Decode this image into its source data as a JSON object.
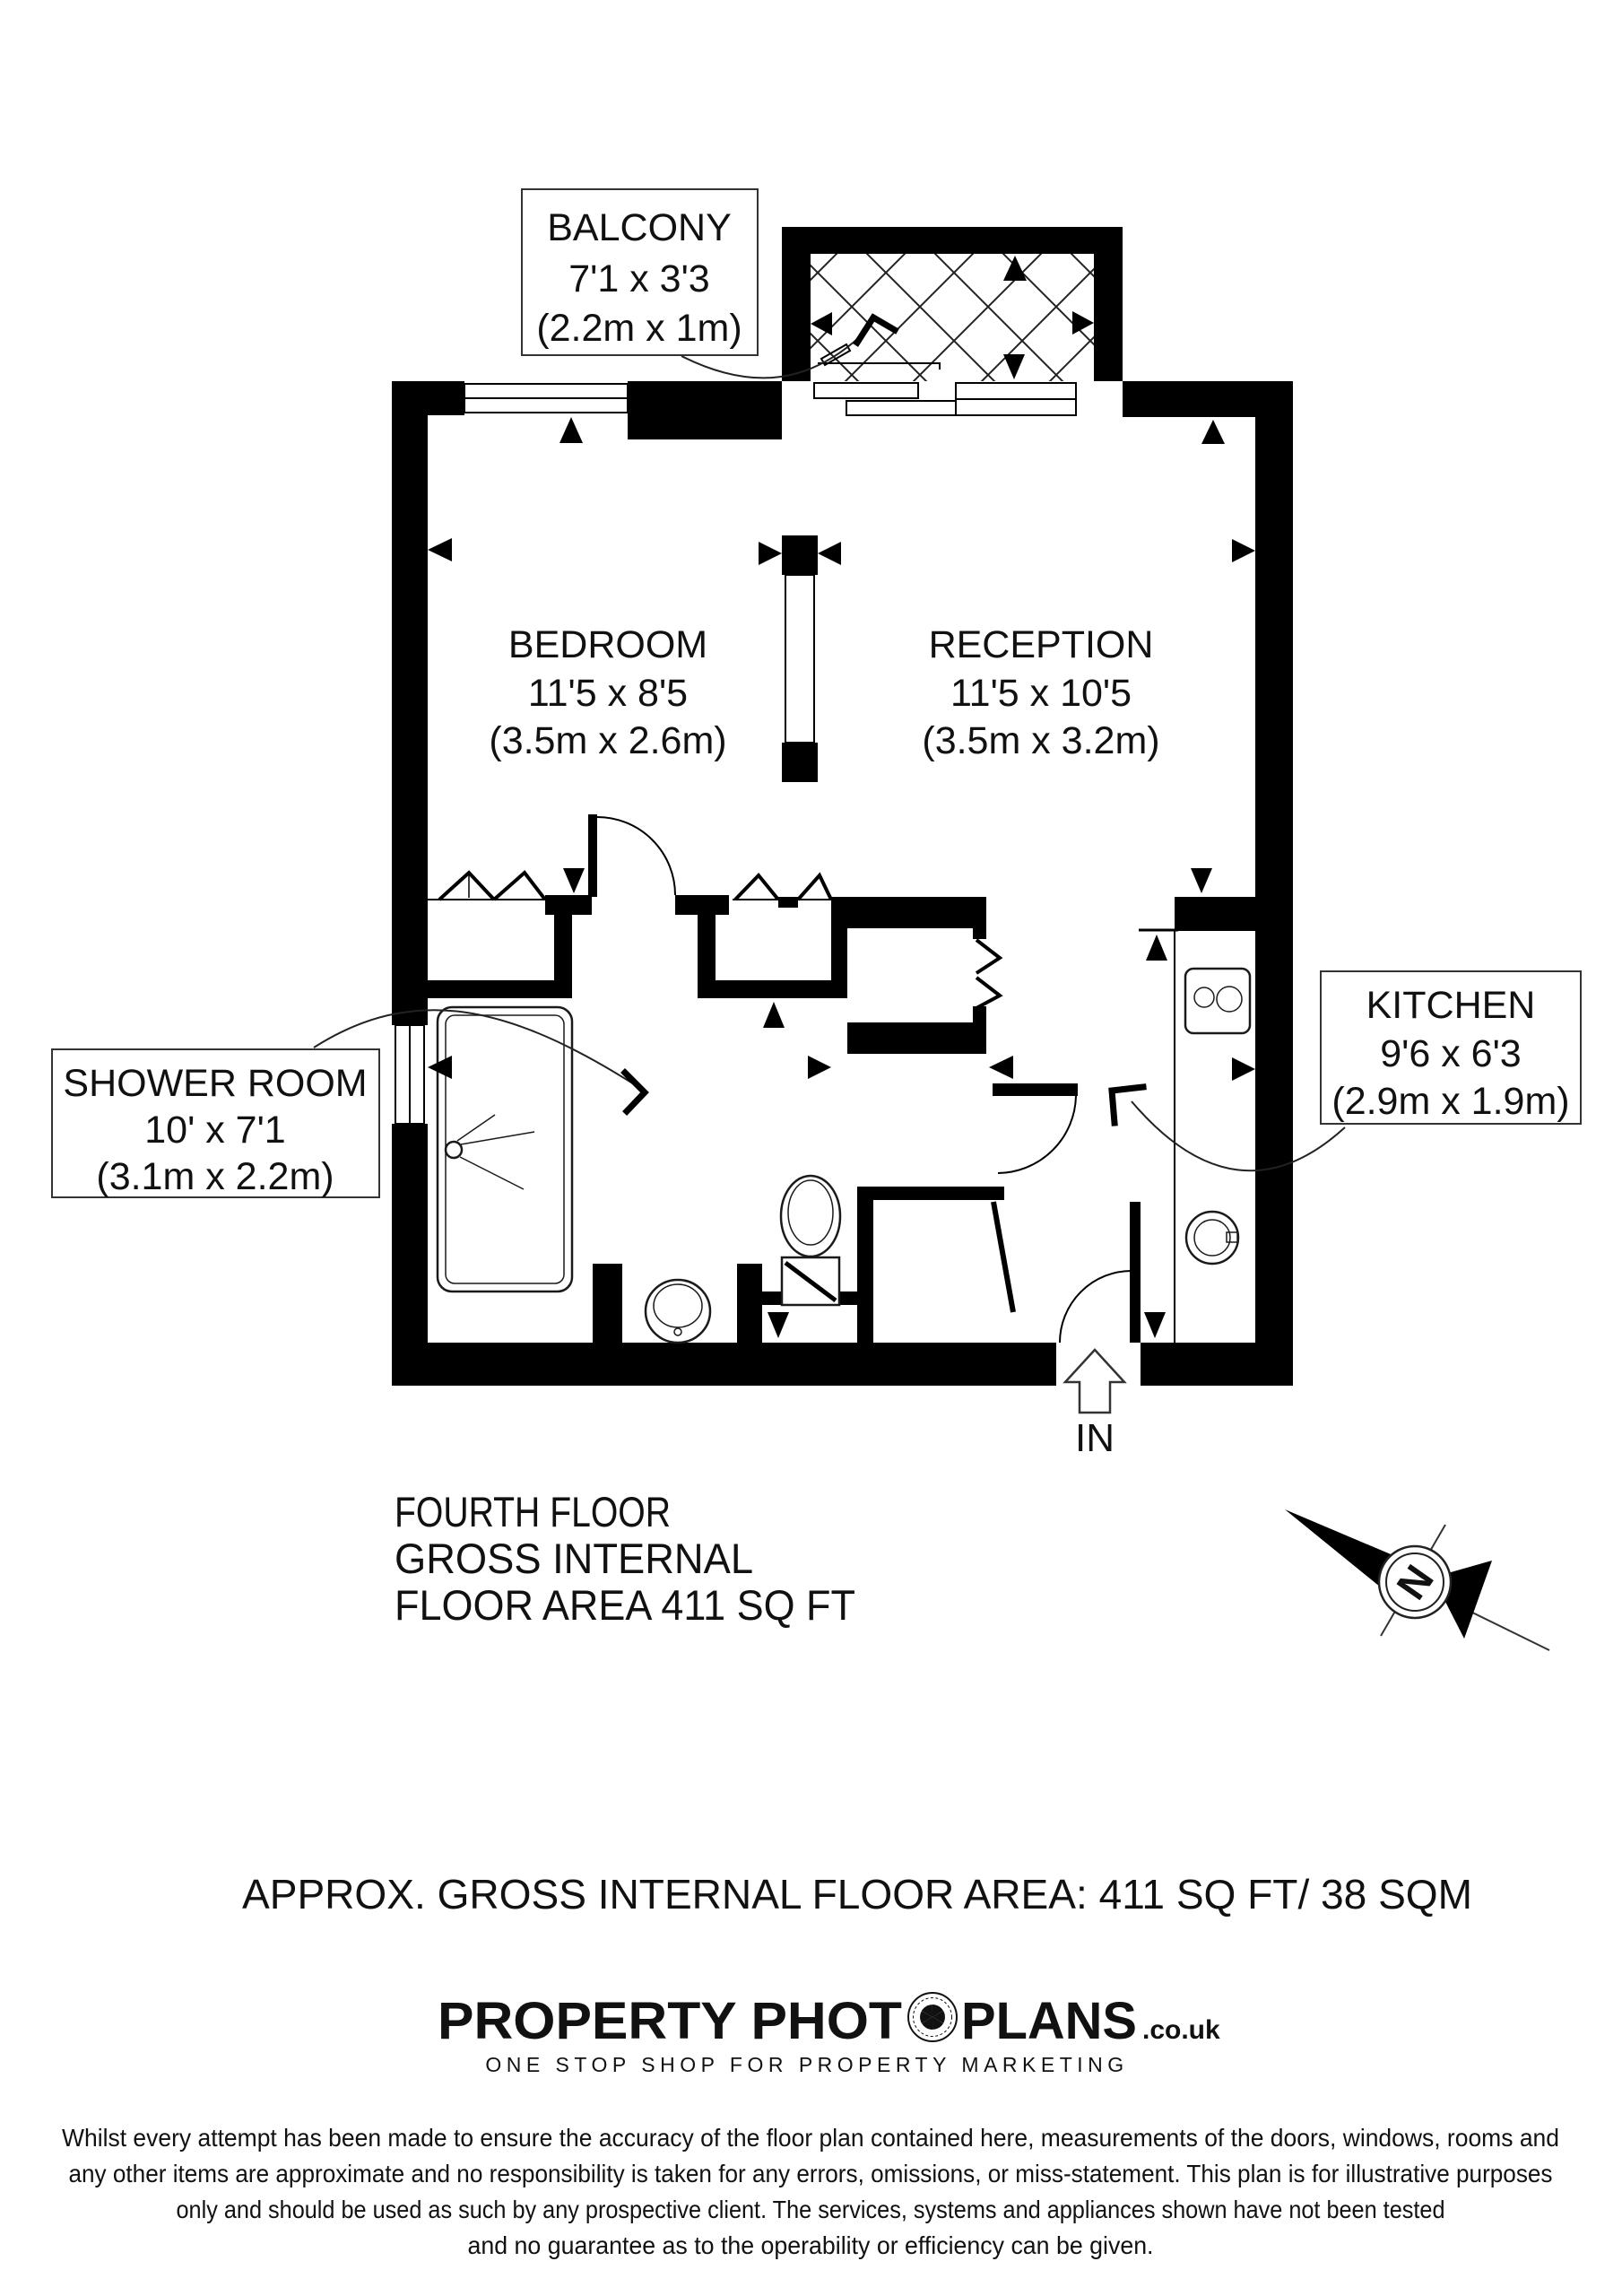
{
  "plan": {
    "rooms": [
      {
        "name": "BALCONY",
        "imperial": "7'1 x 3'3",
        "metric": "(2.2m x 1m)"
      },
      {
        "name": "BEDROOM",
        "imperial": "11'5 x 8'5",
        "metric": "(3.5m x 2.6m)"
      },
      {
        "name": "RECEPTION",
        "imperial": "11'5 x 10'5",
        "metric": "(3.5m x 3.2m)"
      },
      {
        "name": "SHOWER ROOM",
        "imperial": "10' x 7'1",
        "metric": "(3.1m x 2.2m)"
      },
      {
        "name": "KITCHEN",
        "imperial": "9'6 x 6'3",
        "metric": "(2.9m x 1.9m)"
      }
    ],
    "entrance_label": "IN",
    "compass_label": "N",
    "floor_summary": {
      "line1": "FOURTH FLOOR",
      "line2": "GROSS INTERNAL",
      "line3": "FLOOR AREA 411 SQ FT"
    },
    "colors": {
      "ink": "#000000",
      "paper": "#ffffff"
    }
  },
  "footer": {
    "area_summary": "APPROX. GROSS INTERNAL FLOOR AREA:    411 SQ FT/  38 SQM",
    "logo": {
      "part1": "PROPERTY PHOT",
      "part2": "PLANS",
      "suffix": ".co.uk",
      "tagline": "ONE STOP SHOP FOR PROPERTY MARKETING"
    },
    "disclaimer": {
      "line1": "Whilst every attempt has been made to ensure the accuracy of the floor plan contained here, measurements of the doors, windows, rooms and",
      "line2": "any other items are approximate and no responsibility is taken for any errors, omissions, or miss-statement. This plan is for illustrative purposes",
      "line3": "only and should be used as such by any prospective client. The services, systems and appliances shown have not been tested",
      "line4": "and no guarantee as to the operability or efficiency can be given."
    }
  }
}
